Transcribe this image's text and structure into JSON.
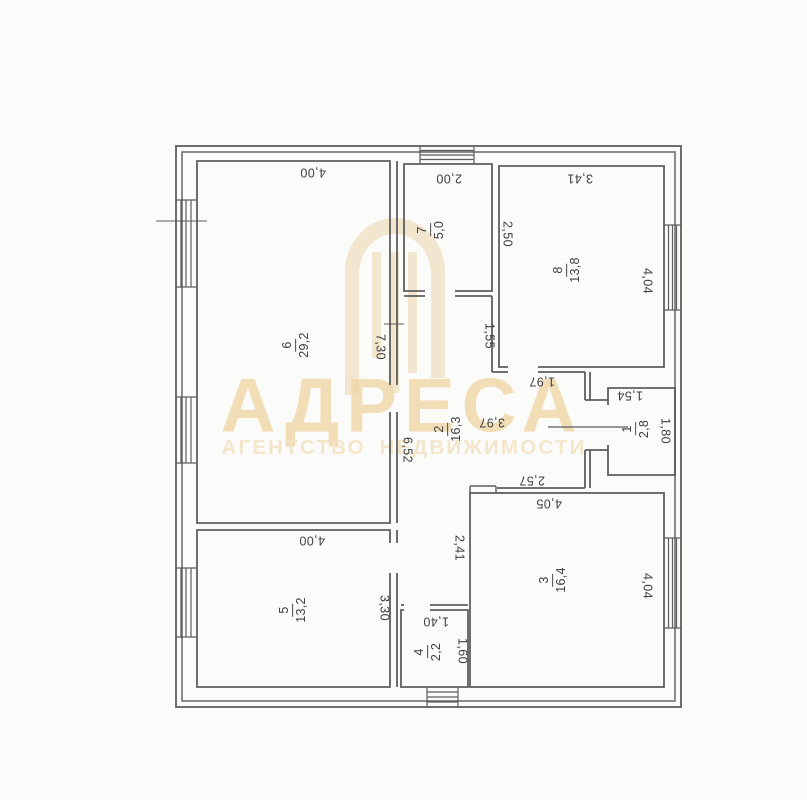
{
  "watermark": {
    "brand": "АДРЕСА",
    "tagline": "АГЕНТСТВО НЕДВИЖИМОСТИ",
    "gold_color": "#eed3a2",
    "logo_icon": "arch-doorway-logo"
  },
  "plan": {
    "wall_color": "#555555",
    "room_labels": [
      {
        "number": "6",
        "area": "29,2",
        "x": 296,
        "y": 345
      },
      {
        "number": "7",
        "area": "5,0",
        "x": 431,
        "y": 230
      },
      {
        "number": "8",
        "area": "13,8",
        "x": 567,
        "y": 270
      },
      {
        "number": "2",
        "area": "16,3",
        "x": 448,
        "y": 429
      },
      {
        "number": "1",
        "area": "2,8",
        "x": 636,
        "y": 429
      },
      {
        "number": "3",
        "area": "16,4",
        "x": 553,
        "y": 580
      },
      {
        "number": "5",
        "area": "13,2",
        "x": 293,
        "y": 610
      },
      {
        "number": "4",
        "area": "2,2",
        "x": 428,
        "y": 652
      }
    ],
    "dimension_labels": [
      {
        "text": "4,00",
        "x": 313,
        "y": 172,
        "rot": "r180"
      },
      {
        "text": "2,00",
        "x": 449,
        "y": 178,
        "rot": "r180"
      },
      {
        "text": "3,41",
        "x": 580,
        "y": 178,
        "rot": "r180"
      },
      {
        "text": "1,97",
        "x": 542,
        "y": 381,
        "rot": "r180"
      },
      {
        "text": "1,54",
        "x": 630,
        "y": 395,
        "rot": "r180"
      },
      {
        "text": "3,97",
        "x": 492,
        "y": 422,
        "rot": "r180"
      },
      {
        "text": "2,57",
        "x": 532,
        "y": 480,
        "rot": "r180"
      },
      {
        "text": "4,05",
        "x": 549,
        "y": 503,
        "rot": "r180"
      },
      {
        "text": "4,00",
        "x": 312,
        "y": 540,
        "rot": "r180"
      },
      {
        "text": "1,40",
        "x": 436,
        "y": 621,
        "rot": "r180"
      },
      {
        "text": "2,50",
        "x": 507,
        "y": 234,
        "rot": "r90"
      },
      {
        "text": "4,04",
        "x": 647,
        "y": 281,
        "rot": "r90"
      },
      {
        "text": "7,30",
        "x": 380,
        "y": 347,
        "rot": "r90"
      },
      {
        "text": "1,55",
        "x": 489,
        "y": 336,
        "rot": "r90"
      },
      {
        "text": "6,52",
        "x": 407,
        "y": 450,
        "rot": "r90"
      },
      {
        "text": "1,80",
        "x": 665,
        "y": 431,
        "rot": "r90"
      },
      {
        "text": "2,41",
        "x": 459,
        "y": 548,
        "rot": "r90"
      },
      {
        "text": "3,30",
        "x": 384,
        "y": 608,
        "rot": "r90"
      },
      {
        "text": "1,60",
        "x": 462,
        "y": 651,
        "rot": "r90"
      },
      {
        "text": "4,04",
        "x": 647,
        "y": 586,
        "rot": "r90"
      }
    ]
  }
}
